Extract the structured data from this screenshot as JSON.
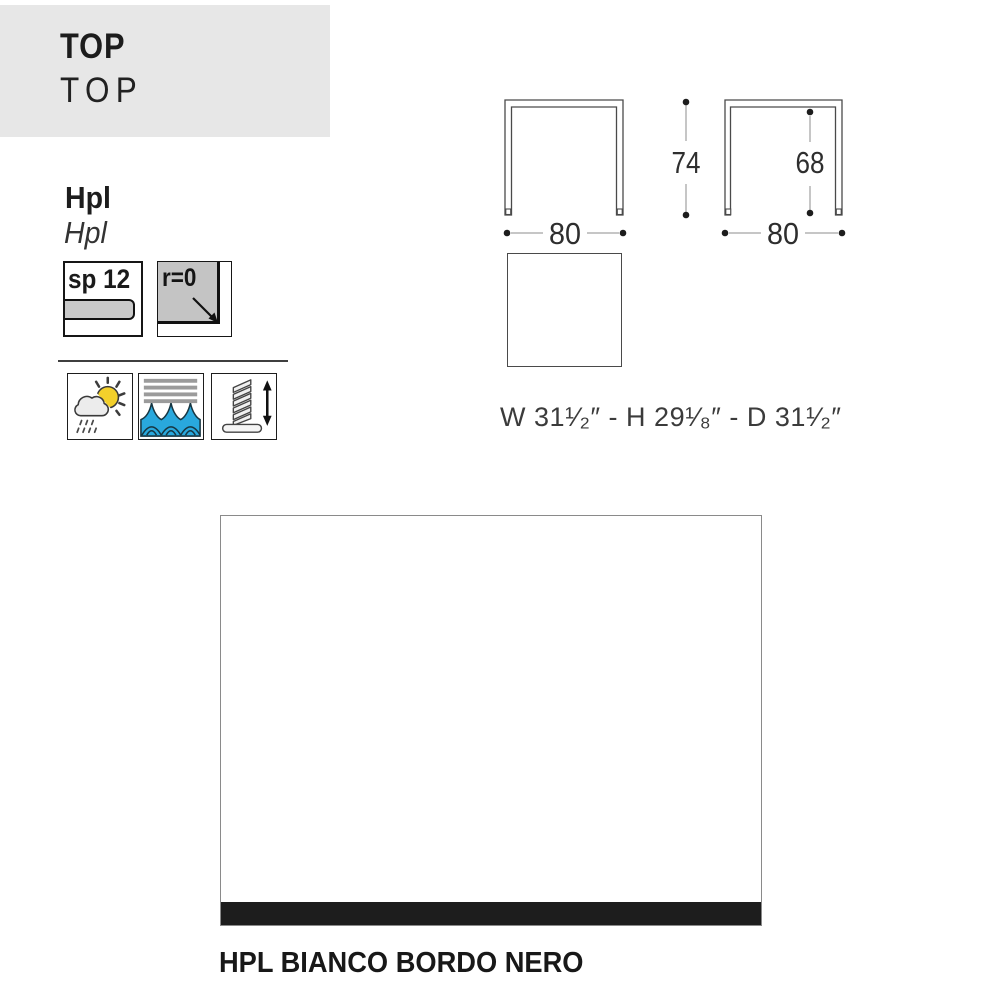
{
  "header": {
    "title": "TOP",
    "subtitle": "TOP",
    "band_color": "#e7e7e7"
  },
  "material": {
    "name_bold": "Hpl",
    "name_italic": "Hpl"
  },
  "specs": {
    "thickness": {
      "label": "sp 12"
    },
    "corner_radius": {
      "label": "r=0"
    }
  },
  "feature_icons": [
    {
      "name": "weather-resistant",
      "glyph": "sun-cloud-rain"
    },
    {
      "name": "water-resistant",
      "glyph": "waves"
    },
    {
      "name": "adjustable-feet",
      "glyph": "screw-glide-with-arrow"
    }
  ],
  "technical_drawings": {
    "front_view_left": {
      "width_cm": "80",
      "height_cm": "74"
    },
    "front_view_right": {
      "width_cm": "80",
      "height_cm": "68"
    }
  },
  "imperial_dimensions": "W 31¹⁄₂″ - H 29¹⁄₈″  - D 31¹⁄₂″",
  "finish_swatch": {
    "caption": "HPL BIANCO BORDO NERO",
    "top_color": "#ffffff",
    "edge_color": "#1d1d1d"
  }
}
